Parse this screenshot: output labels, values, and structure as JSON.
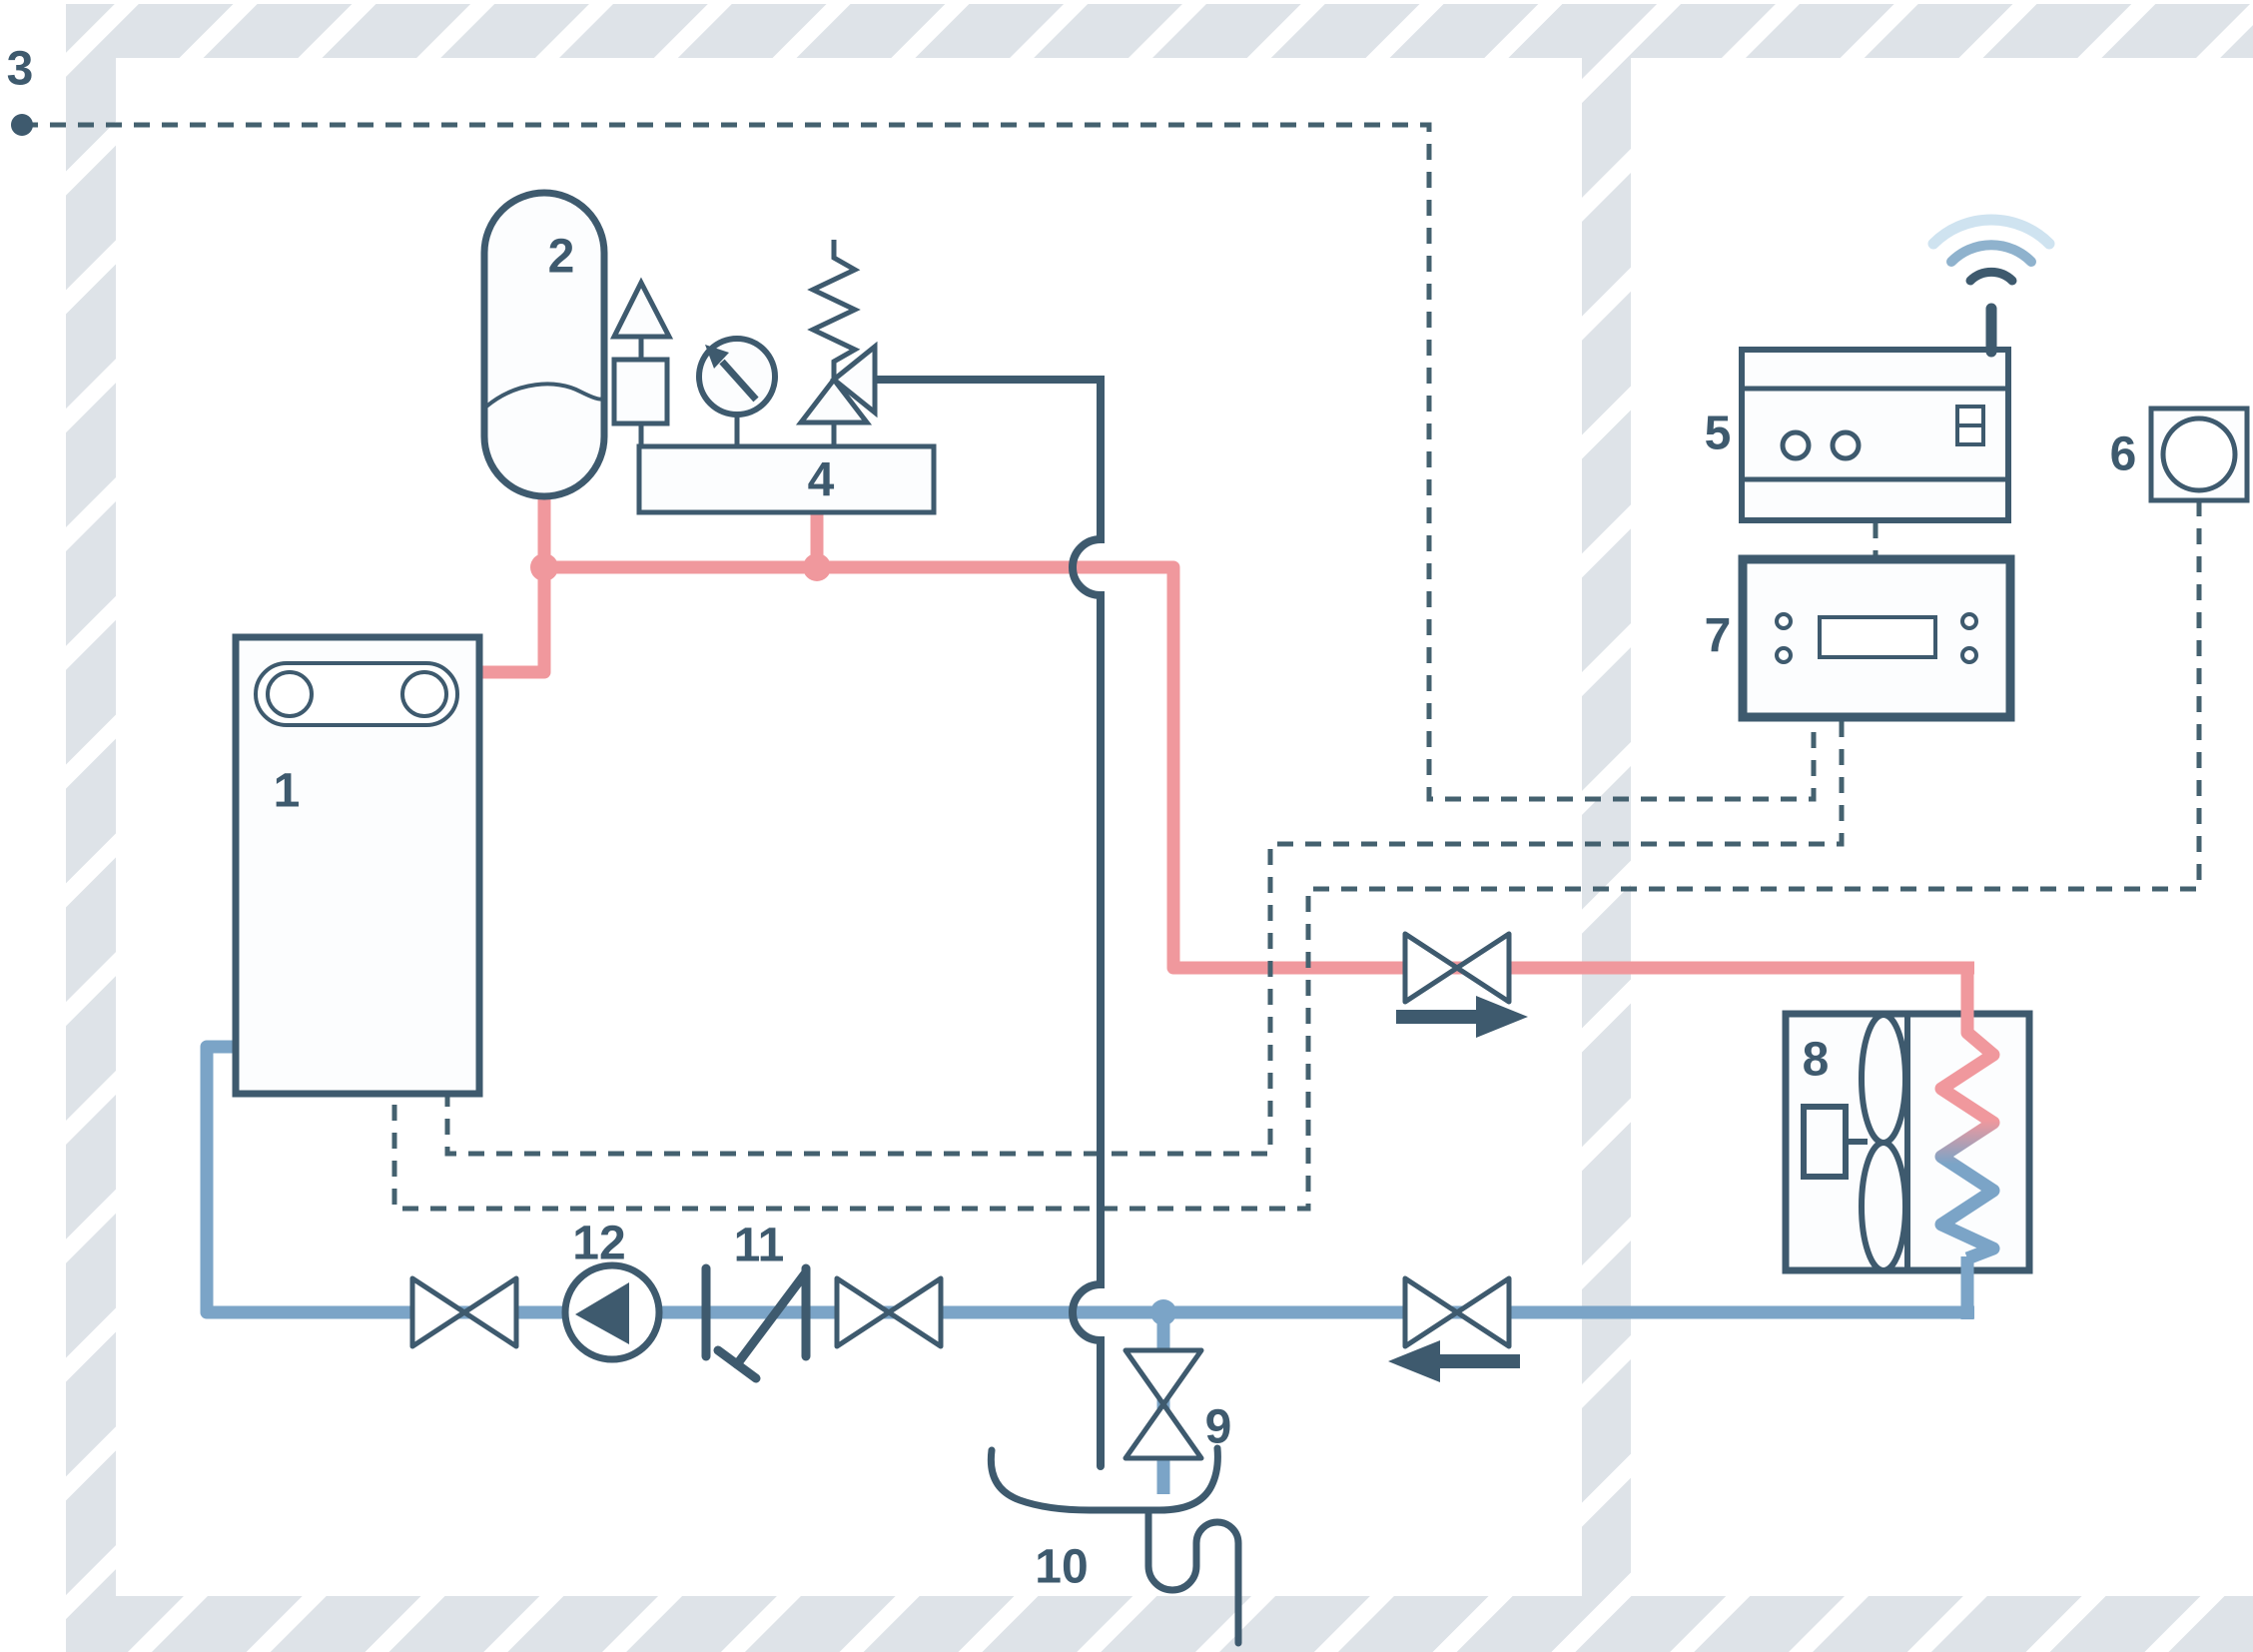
{
  "labels": {
    "indoor_unit": "1",
    "expansion_vessel": "2",
    "outdoor_sensor": "3",
    "safety_group": "4",
    "gateway": "5",
    "room_sensor": "6",
    "controller": "7",
    "outdoor_unit": "8",
    "drain_valve": "9",
    "drain_funnel": "10",
    "strainer": "11",
    "pump": "12"
  },
  "colors": {
    "outline": "#3e5a6e",
    "supply_pipe": "#f0989d",
    "return_pipe": "#7ba4c7",
    "signal_line": "#44616f",
    "wall": "#dee3e8",
    "wifi_mid": "#8fb2cd",
    "wifi_light": "#cfe3f0",
    "component_fill": "#fcfdfe",
    "background": "#ffffff"
  }
}
